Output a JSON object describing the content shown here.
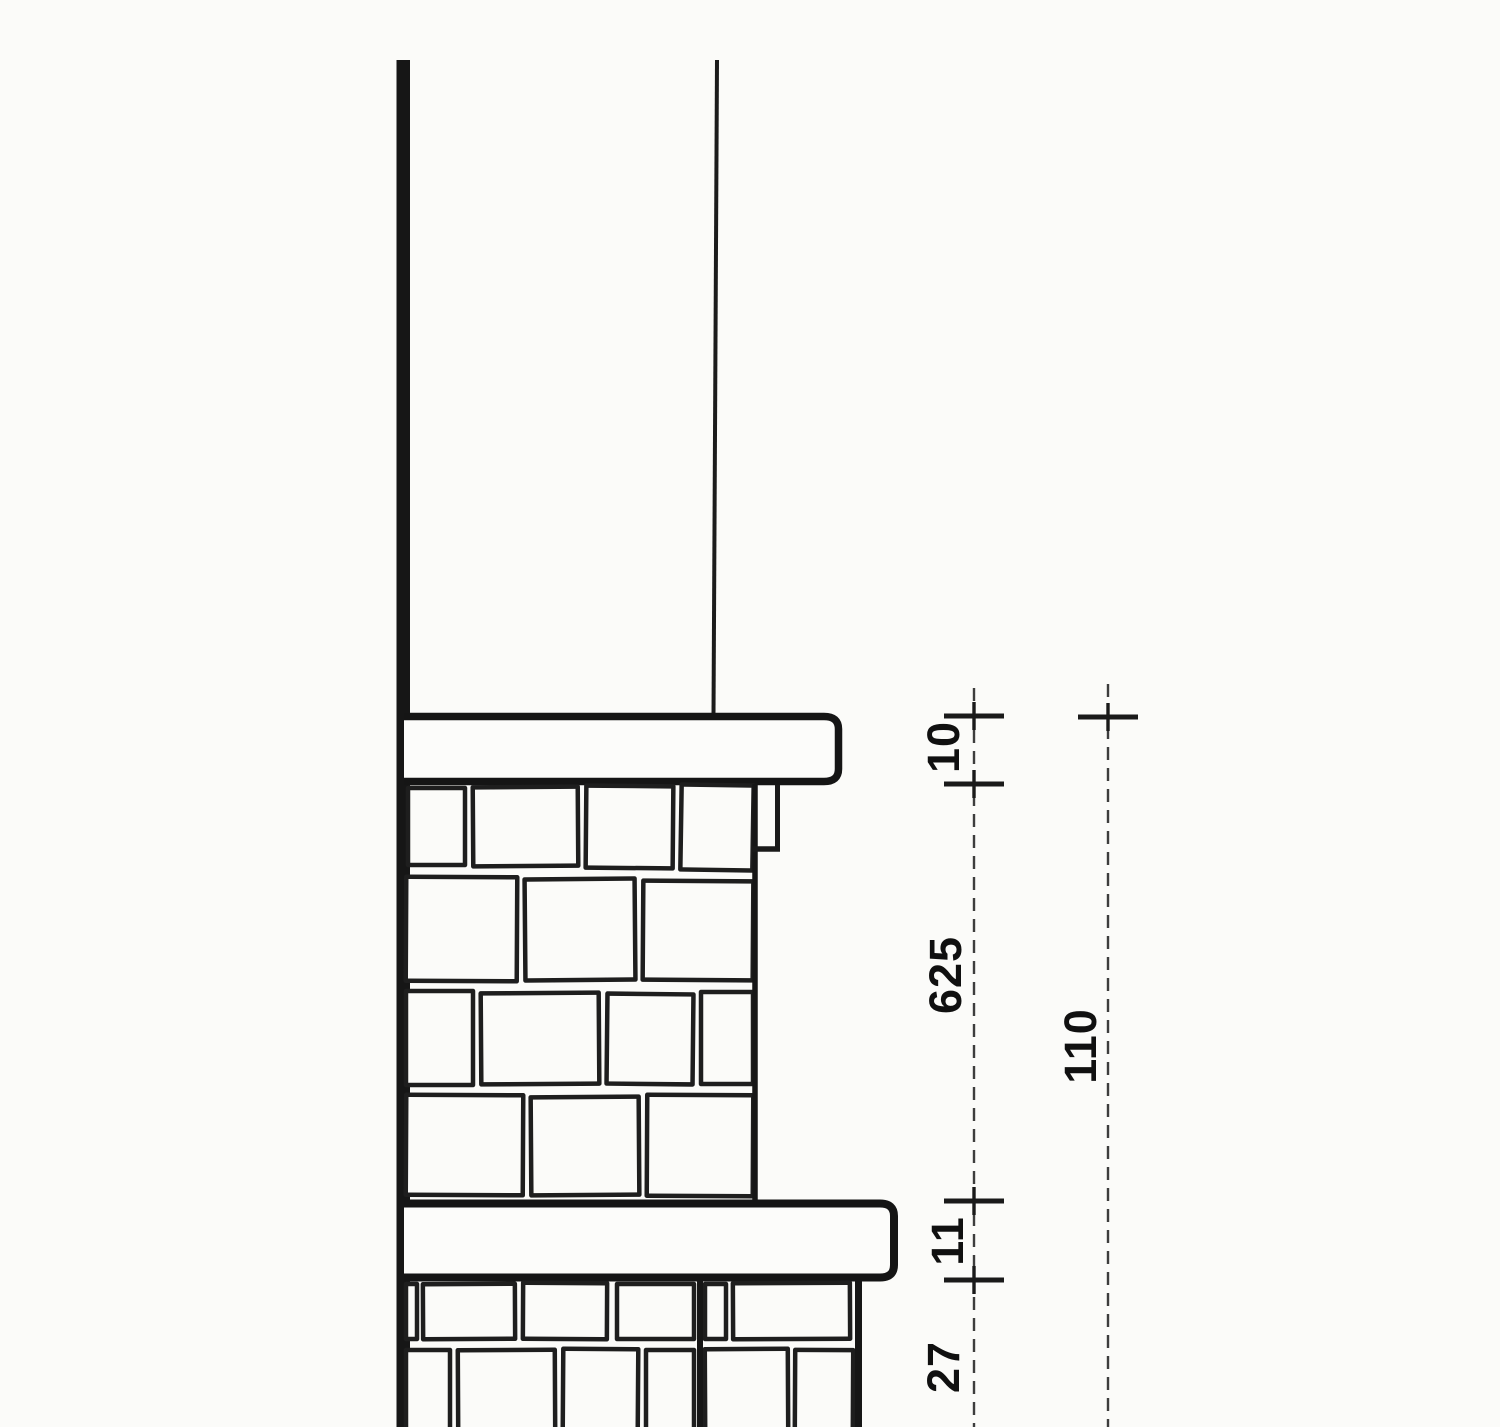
{
  "figure": {
    "title": "Stone wall vertical section detail (scanned line drawing)",
    "colors": {
      "background": "#fbfbf9",
      "ink": "#161616",
      "dimension_line": "#3d3d3d"
    },
    "dimensions": [
      {
        "id": "upper-cap-thickness",
        "label": "10"
      },
      {
        "id": "upper-wall-height",
        "label": "625"
      },
      {
        "id": "overall-height",
        "label": "110"
      },
      {
        "id": "string-course-thickness",
        "label": "11"
      },
      {
        "id": "lower-wall-visible-height",
        "label": "27"
      }
    ]
  }
}
